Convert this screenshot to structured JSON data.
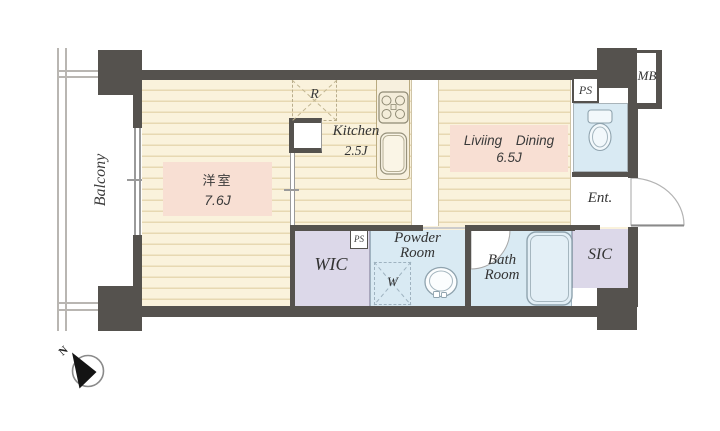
{
  "floorplan": {
    "balcony_label": "Balcony",
    "compass_north_label": "N",
    "western_room": {
      "name": "洋室",
      "size": "7.6J"
    },
    "living_dining": {
      "name": "Liviing Dining",
      "size": "6.5J"
    },
    "kitchen": {
      "name": "Kitchen",
      "size": "2.5J"
    },
    "wic_label": "WIC",
    "sic_label": "SIC",
    "entrance_label": "Ent.",
    "powder_room": {
      "line1": "Powder",
      "line2": "Room"
    },
    "bath_room": {
      "line1": "Bath",
      "line2": "Room"
    },
    "refrigerator_label": "R",
    "washer_label": "W",
    "meter_box_label": "MB",
    "pipe_space_top_label": "PS",
    "pipe_space_wic_label": "PS",
    "colors": {
      "wall": "#55524e",
      "floor": "#faf2dc",
      "floor_line": "#e7d8b2",
      "room_label_bg": "#f8dfd3",
      "closet_bg": "#dcd8e9",
      "wet_area_bg": "#d9eaf3",
      "counter_bg": "#f7f0de"
    }
  }
}
